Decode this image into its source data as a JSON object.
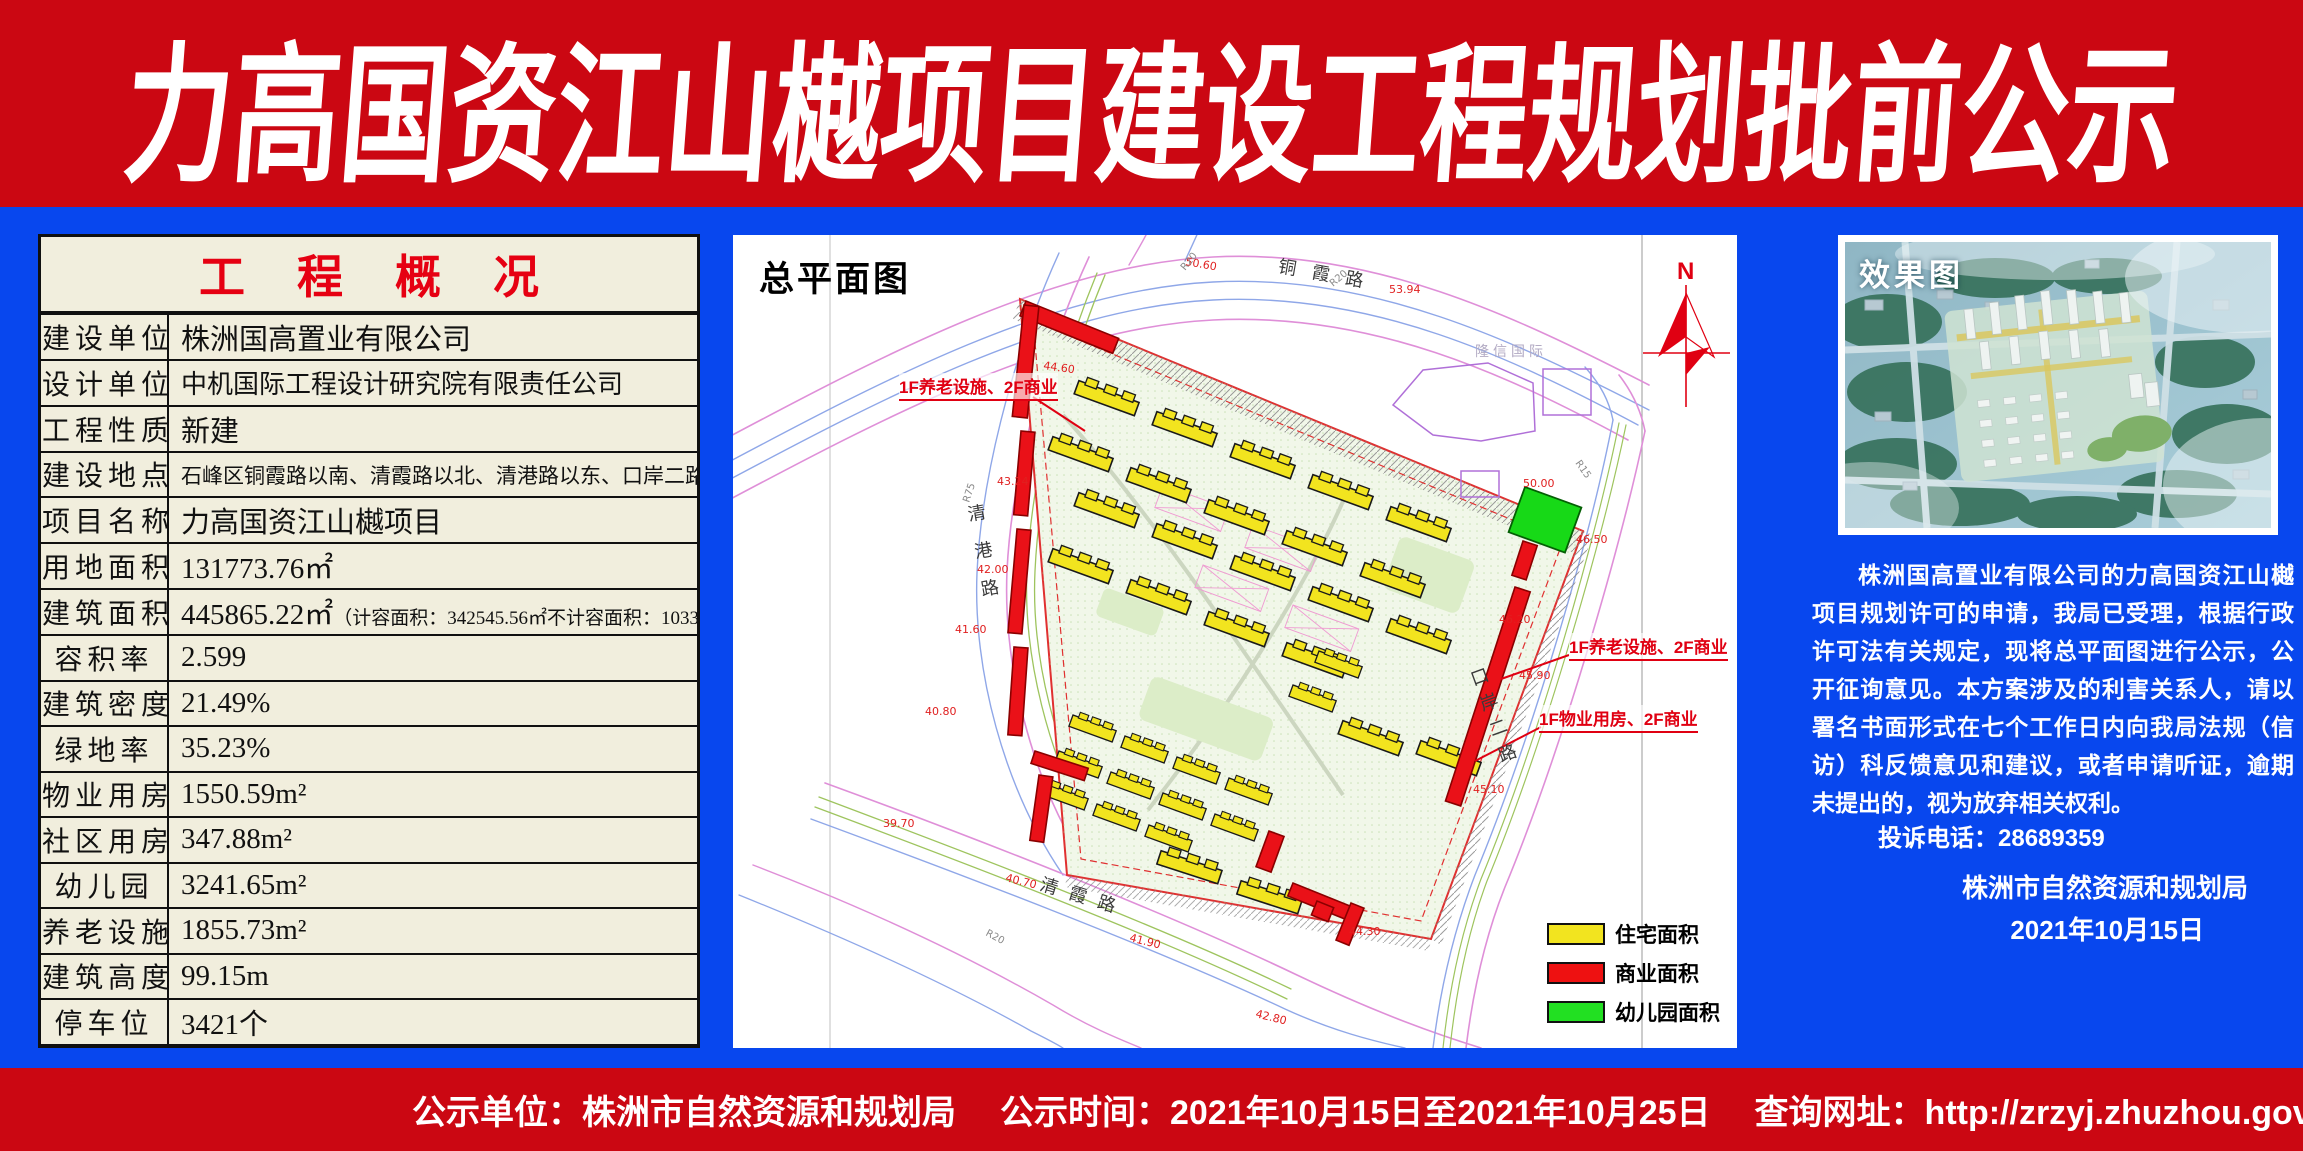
{
  "header": {
    "title": "力高国资江山樾项目建设工程规划批前公示"
  },
  "overview": {
    "title": "工程概况",
    "rows": [
      {
        "label": "建设单位",
        "value": "株洲国高置业有限公司"
      },
      {
        "label": "设计单位",
        "value": "中机国际工程设计研究院有限责任公司"
      },
      {
        "label": "工程性质",
        "value": "新建"
      },
      {
        "label": "建设地点",
        "value": "石峰区铜霞路以南、清霞路以北、清港路以东、口岸二路以西"
      },
      {
        "label": "项目名称",
        "value": "力高国资江山樾项目"
      },
      {
        "label": "用地面积",
        "value": "131773.76㎡"
      },
      {
        "label": "建筑面积",
        "value": "445865.22㎡",
        "note": "（计容面积：342545.56㎡不计容面积：103319.66㎡）"
      },
      {
        "label": "容积率",
        "value": "2.599"
      },
      {
        "label": "建筑密度",
        "value": "21.49%"
      },
      {
        "label": "绿地率",
        "value": "35.23%"
      },
      {
        "label": "物业用房",
        "value": "1550.59m²"
      },
      {
        "label": "社区用房",
        "value": "347.88m²"
      },
      {
        "label": "幼儿园",
        "value": "3241.65m²"
      },
      {
        "label": "养老设施",
        "value": "1855.73m²"
      },
      {
        "label": "建筑高度",
        "value": "99.15m"
      },
      {
        "label": "停车位",
        "value": "3421个"
      }
    ]
  },
  "siteplan": {
    "title": "总平面图",
    "north_label": "N",
    "roads": {
      "north": "铜霞路",
      "west": "清港路",
      "south": "清霞路",
      "east": "口岸二路"
    },
    "existing_building": "隆信国际",
    "annotations": [
      "1F养老设施、2F商业",
      "1F养老设施、2F商业",
      "1F物业用房、2F商业"
    ],
    "elevations": [
      "50.60",
      "53.94",
      "50.00",
      "46.50",
      "46.20",
      "45.90",
      "45.10",
      "44.30",
      "44.60",
      "43.24",
      "42.00",
      "41.60",
      "40.80",
      "39.70",
      "40.70",
      "41.90",
      "42.80"
    ],
    "radius_labels": [
      "R20",
      "R20",
      "R15",
      "R75",
      "R20"
    ],
    "legend": [
      {
        "label": "住宅面积",
        "color": "#f2e41f"
      },
      {
        "label": "商业面积",
        "color": "#ee1111"
      },
      {
        "label": "幼儿园面积",
        "color": "#22e022"
      }
    ]
  },
  "rendering": {
    "title": "效果图"
  },
  "notice": {
    "body": "株洲国高置业有限公司的力高国资江山樾项目规划许可的申请，我局已受理，根据行政许可法有关规定，现将总平面图进行公示，公开征询意见。本方案涉及的利害关系人，请以署名书面形式在七个工作日内向我局法规（信访）科反馈意见和建议，或者申请听证，逾期未提出的，视为放弃相关权利。",
    "phone": "投诉电话：28689359",
    "agency": "株洲市自然资源和规划局",
    "date": "2021年10月15日"
  },
  "footer": {
    "unit": "公示单位：株洲市自然资源和规划局",
    "time": "公示时间：2021年10月15日至2021年10月25日",
    "url": "查询网址：http://zrzyj.zhuzhou.gov.cn"
  },
  "colors": {
    "banner_red": "#cb0712",
    "page_blue": "#0847ee",
    "table_bg": "#f1eedd",
    "title_red": "#e60012",
    "residential_yellow": "#f2e41f",
    "commercial_red": "#ee1111",
    "kindergarten_green": "#22e022"
  }
}
